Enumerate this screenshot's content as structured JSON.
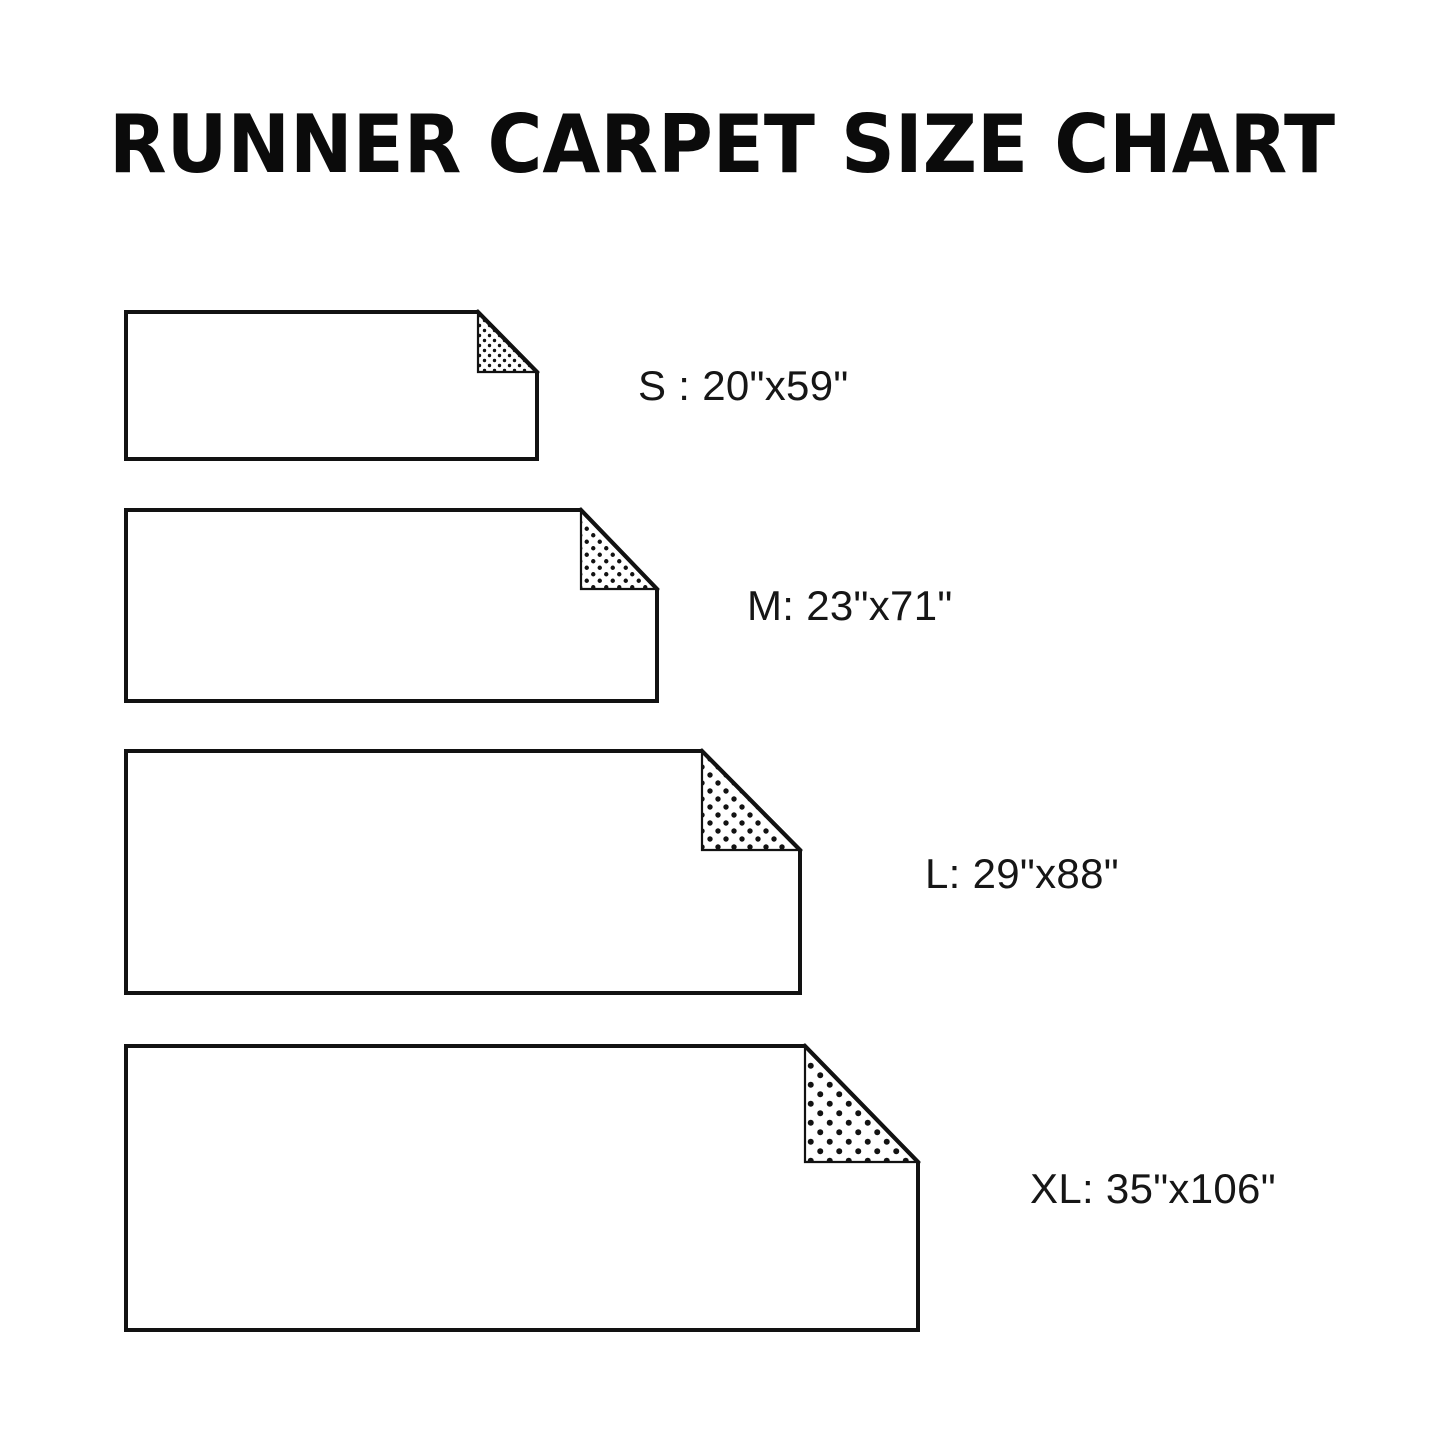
{
  "title": "RUNNER CARPET SIZE CHART",
  "background_color": "#ffffff",
  "ink_color": "#121212",
  "sizes": [
    {
      "code": "S",
      "dimensions": "20\"x59\"",
      "label": "S : 20\"x59\"",
      "figure": {
        "x": 126,
        "y": 312,
        "width": 411,
        "height": 147,
        "fold_width": 59,
        "fold_height": 60,
        "dot_spacing": 10,
        "dot_radius": 1.7
      },
      "label_pos": {
        "x": 638,
        "y": 362
      }
    },
    {
      "code": "M",
      "dimensions": "23\"x71\"",
      "label": "M: 23\"x71\"",
      "figure": {
        "x": 126,
        "y": 510,
        "width": 531,
        "height": 191,
        "fold_width": 76,
        "fold_height": 79,
        "dot_spacing": 13,
        "dot_radius": 2.2
      },
      "label_pos": {
        "x": 747,
        "y": 582
      }
    },
    {
      "code": "L",
      "dimensions": "29\"x88\"",
      "label": "L: 29\"x88\"",
      "figure": {
        "x": 126,
        "y": 751,
        "width": 674,
        "height": 242,
        "fold_width": 98,
        "fold_height": 99,
        "dot_spacing": 16,
        "dot_radius": 2.7
      },
      "label_pos": {
        "x": 925,
        "y": 850
      }
    },
    {
      "code": "XL",
      "dimensions": "35\"x106\"",
      "label": "XL: 35\"x106\"",
      "figure": {
        "x": 126,
        "y": 1046,
        "width": 792,
        "height": 284,
        "fold_width": 113,
        "fold_height": 116,
        "dot_spacing": 19,
        "dot_radius": 3
      },
      "label_pos": {
        "x": 1030,
        "y": 1165
      }
    }
  ]
}
